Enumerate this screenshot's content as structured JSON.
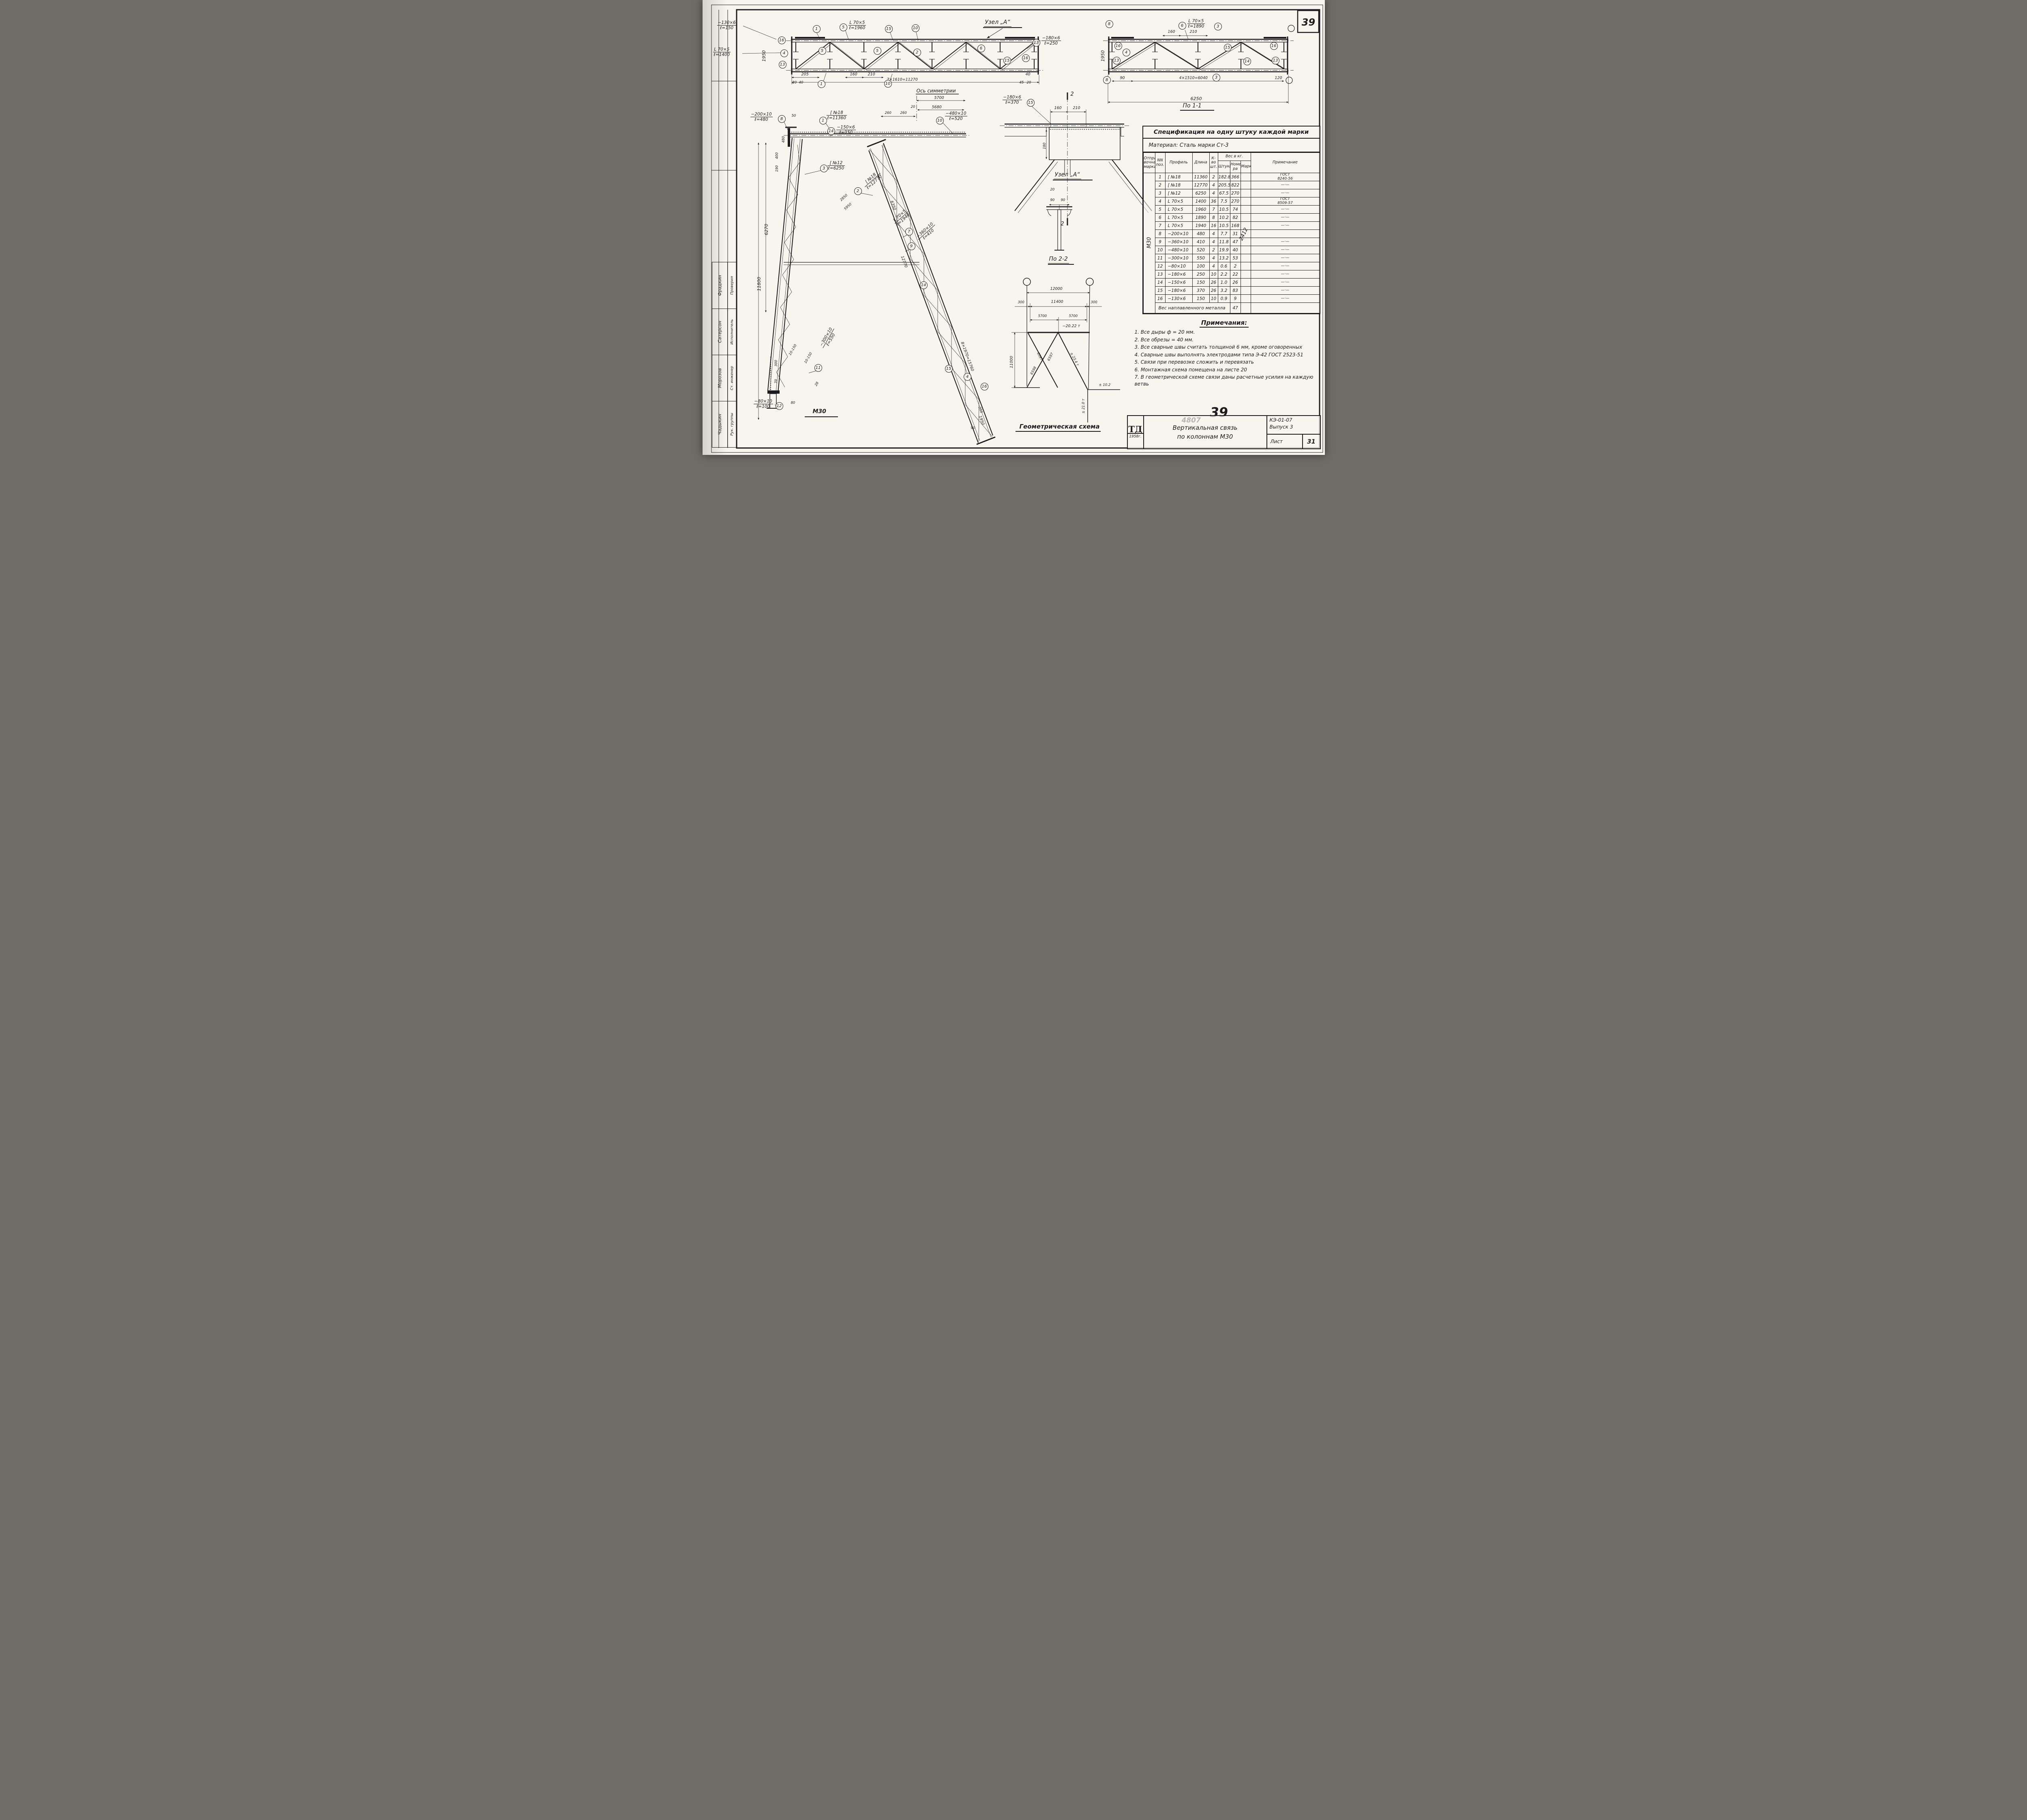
{
  "page": {
    "corner_sheet_no": "39",
    "doc_no": "4807",
    "sheet_no_large": "39"
  },
  "callouts": {
    "c1": "1",
    "c2": "2",
    "c3": "3",
    "c4": "4",
    "c5": "5",
    "c6": "6",
    "c7": "7",
    "c8": "8",
    "c9": "9",
    "c10": "10",
    "c11": "11",
    "c12": "12",
    "c13": "13",
    "c14": "14",
    "c15": "15",
    "c16": "16"
  },
  "labels": {
    "p1": {
      "l1": "[ №18",
      "l2": "ℓ=11360"
    },
    "p2": {
      "l1": "[ №18",
      "l2": "ℓ=12770"
    },
    "p3": {
      "l1": "[ №12",
      "l2": "ℓ=6250"
    },
    "p4": {
      "l1": "L 70×5",
      "l2": "ℓ=1400"
    },
    "p5": {
      "l1": "L 70×5",
      "l2": "ℓ=1960"
    },
    "p6": {
      "l1": "L 70×5",
      "l2": "ℓ=1890"
    },
    "p7": {
      "l1": "L 70×5",
      "l2": "ℓ=1940"
    },
    "p8": {
      "l1": "−200×10",
      "l2": "ℓ=480"
    },
    "p9": {
      "l1": "−360×10",
      "l2": "ℓ=410"
    },
    "p10": {
      "l1": "−480×10",
      "l2": "ℓ=520"
    },
    "p11": {
      "l1": "−300×10",
      "l2": "ℓ=550"
    },
    "p12": {
      "l1": "−80×10",
      "l2": "ℓ=100"
    },
    "p13": {
      "l1": "−180×6",
      "l2": "ℓ=250"
    },
    "p14": {
      "l1": "−150×6",
      "l2": "ℓ=150"
    },
    "p15": {
      "l1": "−180×6",
      "l2": "ℓ=370"
    },
    "p16": {
      "l1": "−130×6",
      "l2": "ℓ=150"
    }
  },
  "dims": {
    "v20": "20",
    "v25": "25",
    "v28": "28",
    "v40": "40",
    "v45": "45",
    "v50": "50",
    "v70": "70",
    "v80": "80",
    "v90": "90",
    "v120": "120",
    "v160": "160",
    "v180": "180",
    "v190": "190",
    "v205": "205",
    "v210": "210",
    "v260": "260",
    "v300": "300",
    "v350": "350",
    "v400": "400",
    "v480": "480",
    "v1950": "1950",
    "v2850": "2850",
    "v5680": "5680",
    "v5700": "5700",
    "v5950": "5950",
    "v6250": "6250",
    "v6270": "6270",
    "v6350": "6350",
    "v11000": "11000",
    "v11400": "11400",
    "v11800": "11800",
    "v12000": "12000",
    "v12770": "12770",
    "v6597": "6597",
    "v6598": "6598",
    "panel7": "7×1610=11270",
    "panel4": "4×1510=6040",
    "panel8": "8×1970=15760",
    "weld_mark": "10-150",
    "sec_mark": "2"
  },
  "forces": {
    "top_chord": "−20.22 т",
    "diag_right": "± 23.4 т",
    "bottom_h": "± 10.2",
    "bottom_v": "± 21.0 т"
  },
  "titles": {
    "axis": "Ось симметрии",
    "uzel_a": "Узел „А“",
    "po11": "По 1-1",
    "po22": "По 2-2",
    "geom": "Геометрическая схема",
    "m30": "М30"
  },
  "spec_table": {
    "title": "Спецификация на одну штуку каждой марки",
    "material": "Материал: Сталь марки Ст-3",
    "col_mark": "Отпра-\nвочная\nмарка",
    "col_pos": "NN\nпоз.",
    "col_profile": "Профиль",
    "col_len": "Длина",
    "col_qty": "К-во\nшт.",
    "col_weight": "Вес в кг.",
    "col_wp": "Штуки",
    "col_wn": "Номе-\nра",
    "col_wm": "Марки",
    "col_note": "Примечание",
    "shipping_mark": "М30",
    "mark_no": "2412",
    "rows": [
      {
        "pos": "1",
        "profile": "[ №18",
        "len": "11360",
        "qty": "2",
        "wp": "182.8",
        "wn": "366",
        "wm": "",
        "note": "ГОСТ\n8240-56"
      },
      {
        "pos": "2",
        "profile": "[ №18",
        "len": "12770",
        "qty": "4",
        "wp": "205.5",
        "wn": "822",
        "wm": "",
        "note": "—·—"
      },
      {
        "pos": "3",
        "profile": "[ №12",
        "len": "6250",
        "qty": "4",
        "wp": "67.5",
        "wn": "270",
        "wm": "",
        "note": "—·—"
      },
      {
        "pos": "4",
        "profile": "L 70×5",
        "len": "1400",
        "qty": "36",
        "wp": "7.5",
        "wn": "270",
        "wm": "",
        "note": "ГОСТ\n8509-57"
      },
      {
        "pos": "5",
        "profile": "L 70×5",
        "len": "1960",
        "qty": "7",
        "wp": "10.5",
        "wn": "74",
        "wm": "",
        "note": "—·—"
      },
      {
        "pos": "6",
        "profile": "L 70×5",
        "len": "1890",
        "qty": "8",
        "wp": "10.2",
        "wn": "82",
        "wm": "",
        "note": "—·—"
      },
      {
        "pos": "7",
        "profile": "L 70×5",
        "len": "1940",
        "qty": "16",
        "wp": "10.5",
        "wn": "168",
        "wm": "",
        "note": "—·—"
      },
      {
        "pos": "8",
        "profile": "−200×10",
        "len": "480",
        "qty": "4",
        "wp": "7.7",
        "wn": "31",
        "wm": "",
        "note": ""
      },
      {
        "pos": "9",
        "profile": "−360×10",
        "len": "410",
        "qty": "4",
        "wp": "11.8",
        "wn": "47",
        "wm": "",
        "note": "—·—"
      },
      {
        "pos": "10",
        "profile": "−480×10",
        "len": "520",
        "qty": "2",
        "wp": "19.9",
        "wn": "40",
        "wm": "",
        "note": "—·—"
      },
      {
        "pos": "11",
        "profile": "−300×10",
        "len": "550",
        "qty": "4",
        "wp": "13.2",
        "wn": "53",
        "wm": "",
        "note": "—·—"
      },
      {
        "pos": "12",
        "profile": "−80×10",
        "len": "100",
        "qty": "4",
        "wp": "0.6",
        "wn": "2",
        "wm": "",
        "note": "—·—"
      },
      {
        "pos": "13",
        "profile": "−180×6",
        "len": "250",
        "qty": "10",
        "wp": "2.2",
        "wn": "22",
        "wm": "",
        "note": "—·—"
      },
      {
        "pos": "14",
        "profile": "−150×6",
        "len": "150",
        "qty": "26",
        "wp": "1.0",
        "wn": "26",
        "wm": "",
        "note": "—·—"
      },
      {
        "pos": "15",
        "profile": "−180×6",
        "len": "370",
        "qty": "26",
        "wp": "3.2",
        "wn": "83",
        "wm": "",
        "note": "—·—"
      },
      {
        "pos": "16",
        "profile": "−130×6",
        "len": "150",
        "qty": "10",
        "wp": "0.9",
        "wn": "9",
        "wm": "",
        "note": "—·—"
      }
    ],
    "weld_label": "Вес наплавленного металла",
    "weld_value": "47"
  },
  "notes": {
    "title": "Примечания:",
    "items": [
      "1. Все дыры ф = 20 мм.",
      "2. Все обрезы = 40 мм.",
      "3. Все сварные швы считать толщиной 6 мм, кроме оговоренных",
      "4. Сварные швы выполнять электродами типа Э-42 ГОСТ 2523-51",
      "5. Связи при перевозке сложить и перевязать",
      "6. Монтажная схема помещена на листе 20",
      "7. В геометрической схеме связи даны расчетные усилия на каждую ветвь"
    ]
  },
  "titleblock": {
    "logo": "ТД",
    "year": "1958г.",
    "title_l1": "Вертикальная связь",
    "title_l2": "по колоннам М30",
    "code": "КЭ-01-07",
    "issue": "Выпуск 3",
    "sheet_word": "Лист",
    "sheet_no": "31"
  },
  "stamp": {
    "rows": [
      {
        "role": "Рук. группы",
        "name": "Чадыкин"
      },
      {
        "role": "Ст. инженер",
        "name": "Морозов"
      },
      {
        "role": "Исполнитель",
        "name": "Сатерсон"
      },
      {
        "role": "Проверил",
        "name": "Фрадкин"
      }
    ]
  }
}
